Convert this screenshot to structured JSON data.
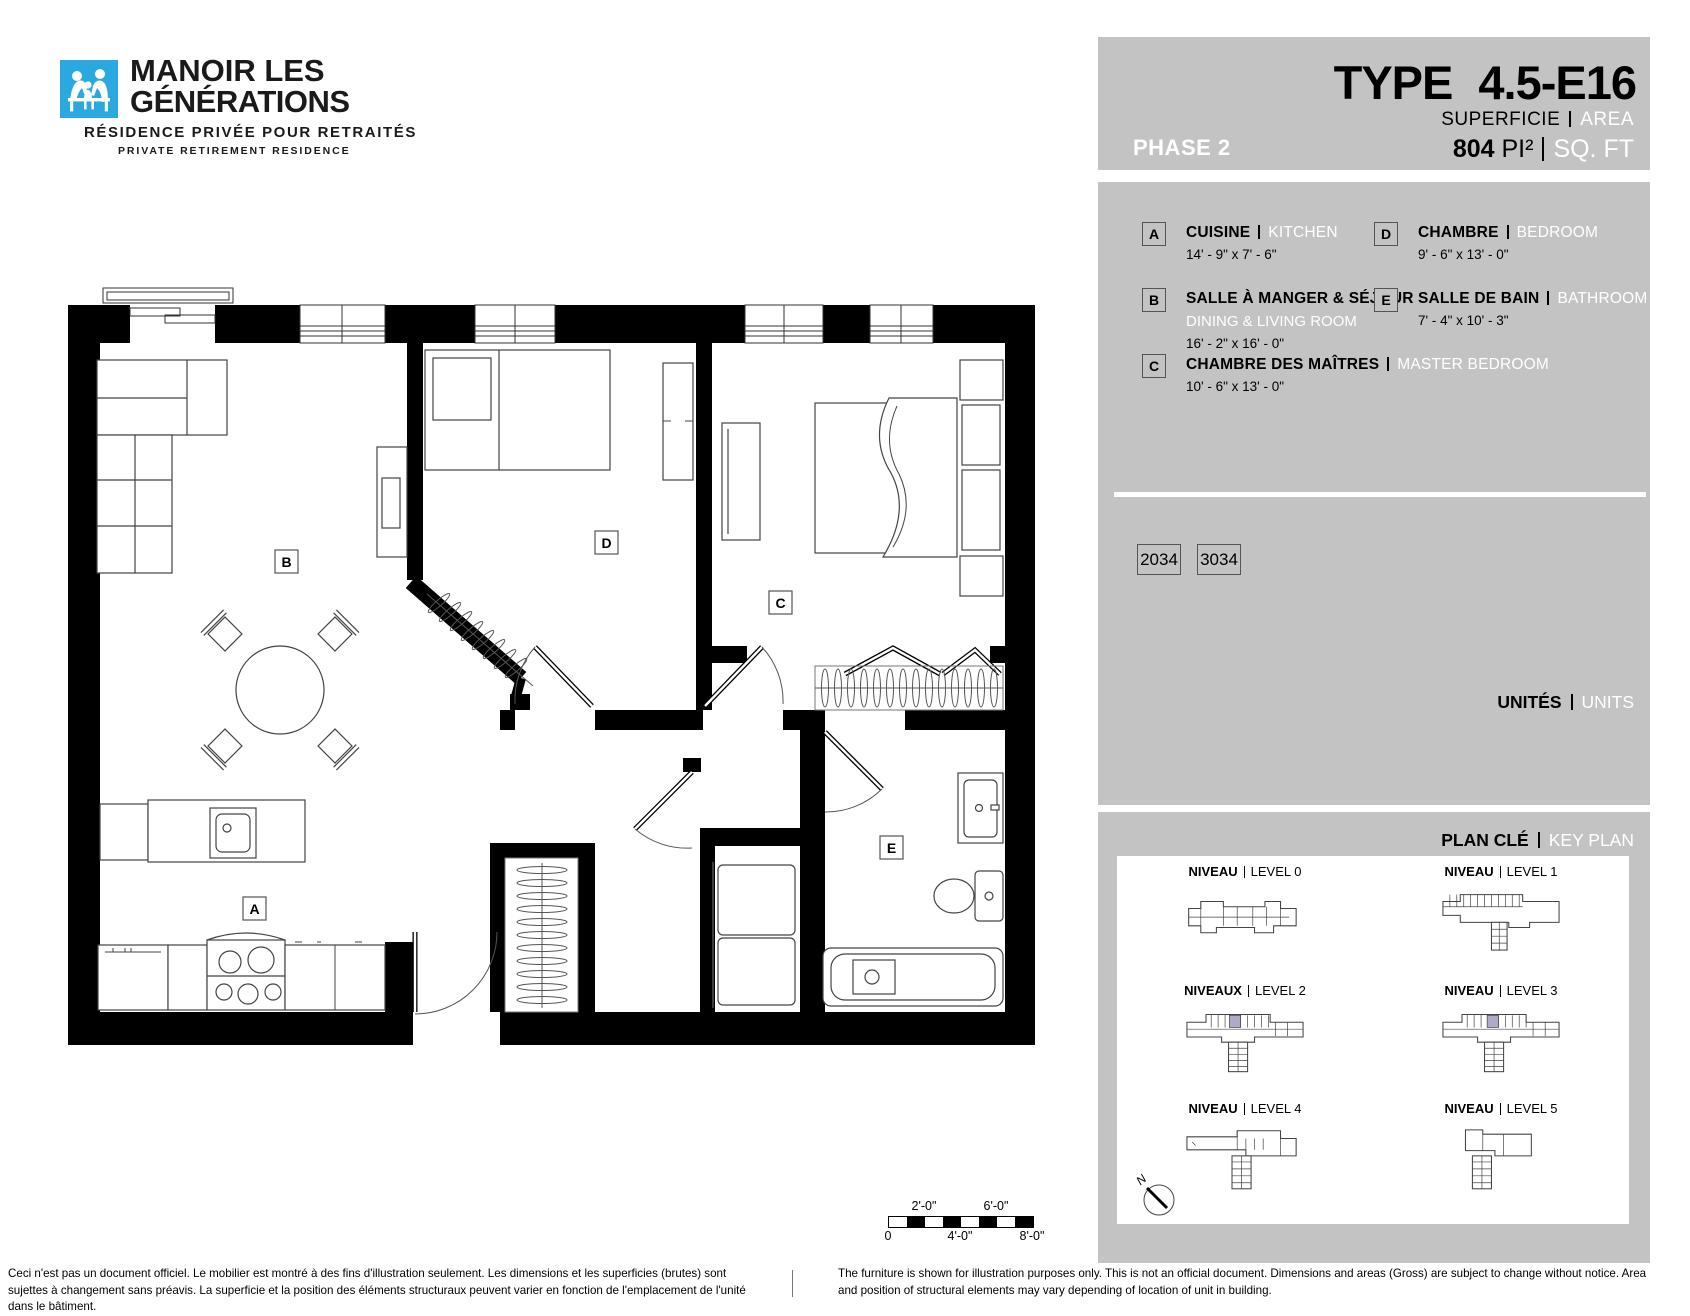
{
  "logo": {
    "line1": "MANOIR LES",
    "line2": "GÉNÉRATIONS",
    "subtitle_fr": "RÉSIDENCE PRIVÉE POUR RETRAITÉS",
    "subtitle_en": "PRIVATE RETIREMENT RESIDENCE"
  },
  "header": {
    "phase": "PHASE 2",
    "type_label": "TYPE",
    "type_value": "4.5-E16",
    "superficie_fr": "SUPERFICIE",
    "superficie_en": "AREA",
    "area_value": "804",
    "area_unit_fr": "PI²",
    "area_unit_en": "SQ. FT"
  },
  "legend": {
    "items": [
      {
        "key": "A",
        "fr": "CUISINE",
        "en": "KITCHEN",
        "dims": "14' - 9\" x 7' - 6\""
      },
      {
        "key": "B",
        "fr": "SALLE À MANGER & SÉJOUR",
        "en": "DINING & LIVING ROOM",
        "dims": "16' - 2\" x 16' - 0\""
      },
      {
        "key": "C",
        "fr": "CHAMBRE DES MAÎTRES",
        "en": "MASTER BEDROOM",
        "dims": "10' - 6\" x 13' - 0\""
      },
      {
        "key": "D",
        "fr": "CHAMBRE",
        "en": "BEDROOM",
        "dims": "9' - 6\" x 13' - 0\""
      },
      {
        "key": "E",
        "fr": "SALLE DE BAIN",
        "en": "BATHROOM",
        "dims": "7' - 4\" x 10' - 3\""
      }
    ]
  },
  "units": {
    "title_fr": "UNITÉS",
    "title_en": "UNITS",
    "numbers": [
      "2034",
      "3034"
    ]
  },
  "keyplan": {
    "title_fr": "PLAN CLÉ",
    "title_en": "KEY PLAN",
    "north": "N",
    "levels": [
      {
        "fr": "NIVEAU",
        "en": "LEVEL 0"
      },
      {
        "fr": "NIVEAU",
        "en": "LEVEL 1"
      },
      {
        "fr": "NIVEAUX",
        "en": "LEVEL 2"
      },
      {
        "fr": "NIVEAU",
        "en": "LEVEL 3"
      },
      {
        "fr": "NIVEAU",
        "en": "LEVEL 4"
      },
      {
        "fr": "NIVEAU",
        "en": "LEVEL 5"
      }
    ]
  },
  "plan": {
    "labels": {
      "a": "A",
      "b": "B",
      "c": "C",
      "d": "D",
      "e": "E"
    }
  },
  "scalebar": {
    "top": [
      "2'-0\"",
      "6'-0\""
    ],
    "bottom": [
      "0",
      "4'-0\"",
      "8'-0\""
    ]
  },
  "disclaimers": {
    "fr": "Ceci n'est pas un document officiel.  Le mobilier est montré à des fins d'illustration seulement.  Les dimensions et les superficies (brutes) sont sujettes à changement sans préavis. La superficie et la position des éléments structuraux peuvent varier en fonction de l'emplacement de l'unité dans le bâtiment.",
    "en": "The furniture is shown for illustration purposes only.  This is not an official document.  Dimensions and areas (Gross) are subject to change without notice. Area and position of structural elements may vary depending of location of unit in building."
  },
  "colors": {
    "panel_gray": "#c3c3c3",
    "logo_blue": "#29a9e0",
    "keyplan_highlight": "#b1a9c9",
    "wall_black": "#000000",
    "white": "#ffffff"
  }
}
